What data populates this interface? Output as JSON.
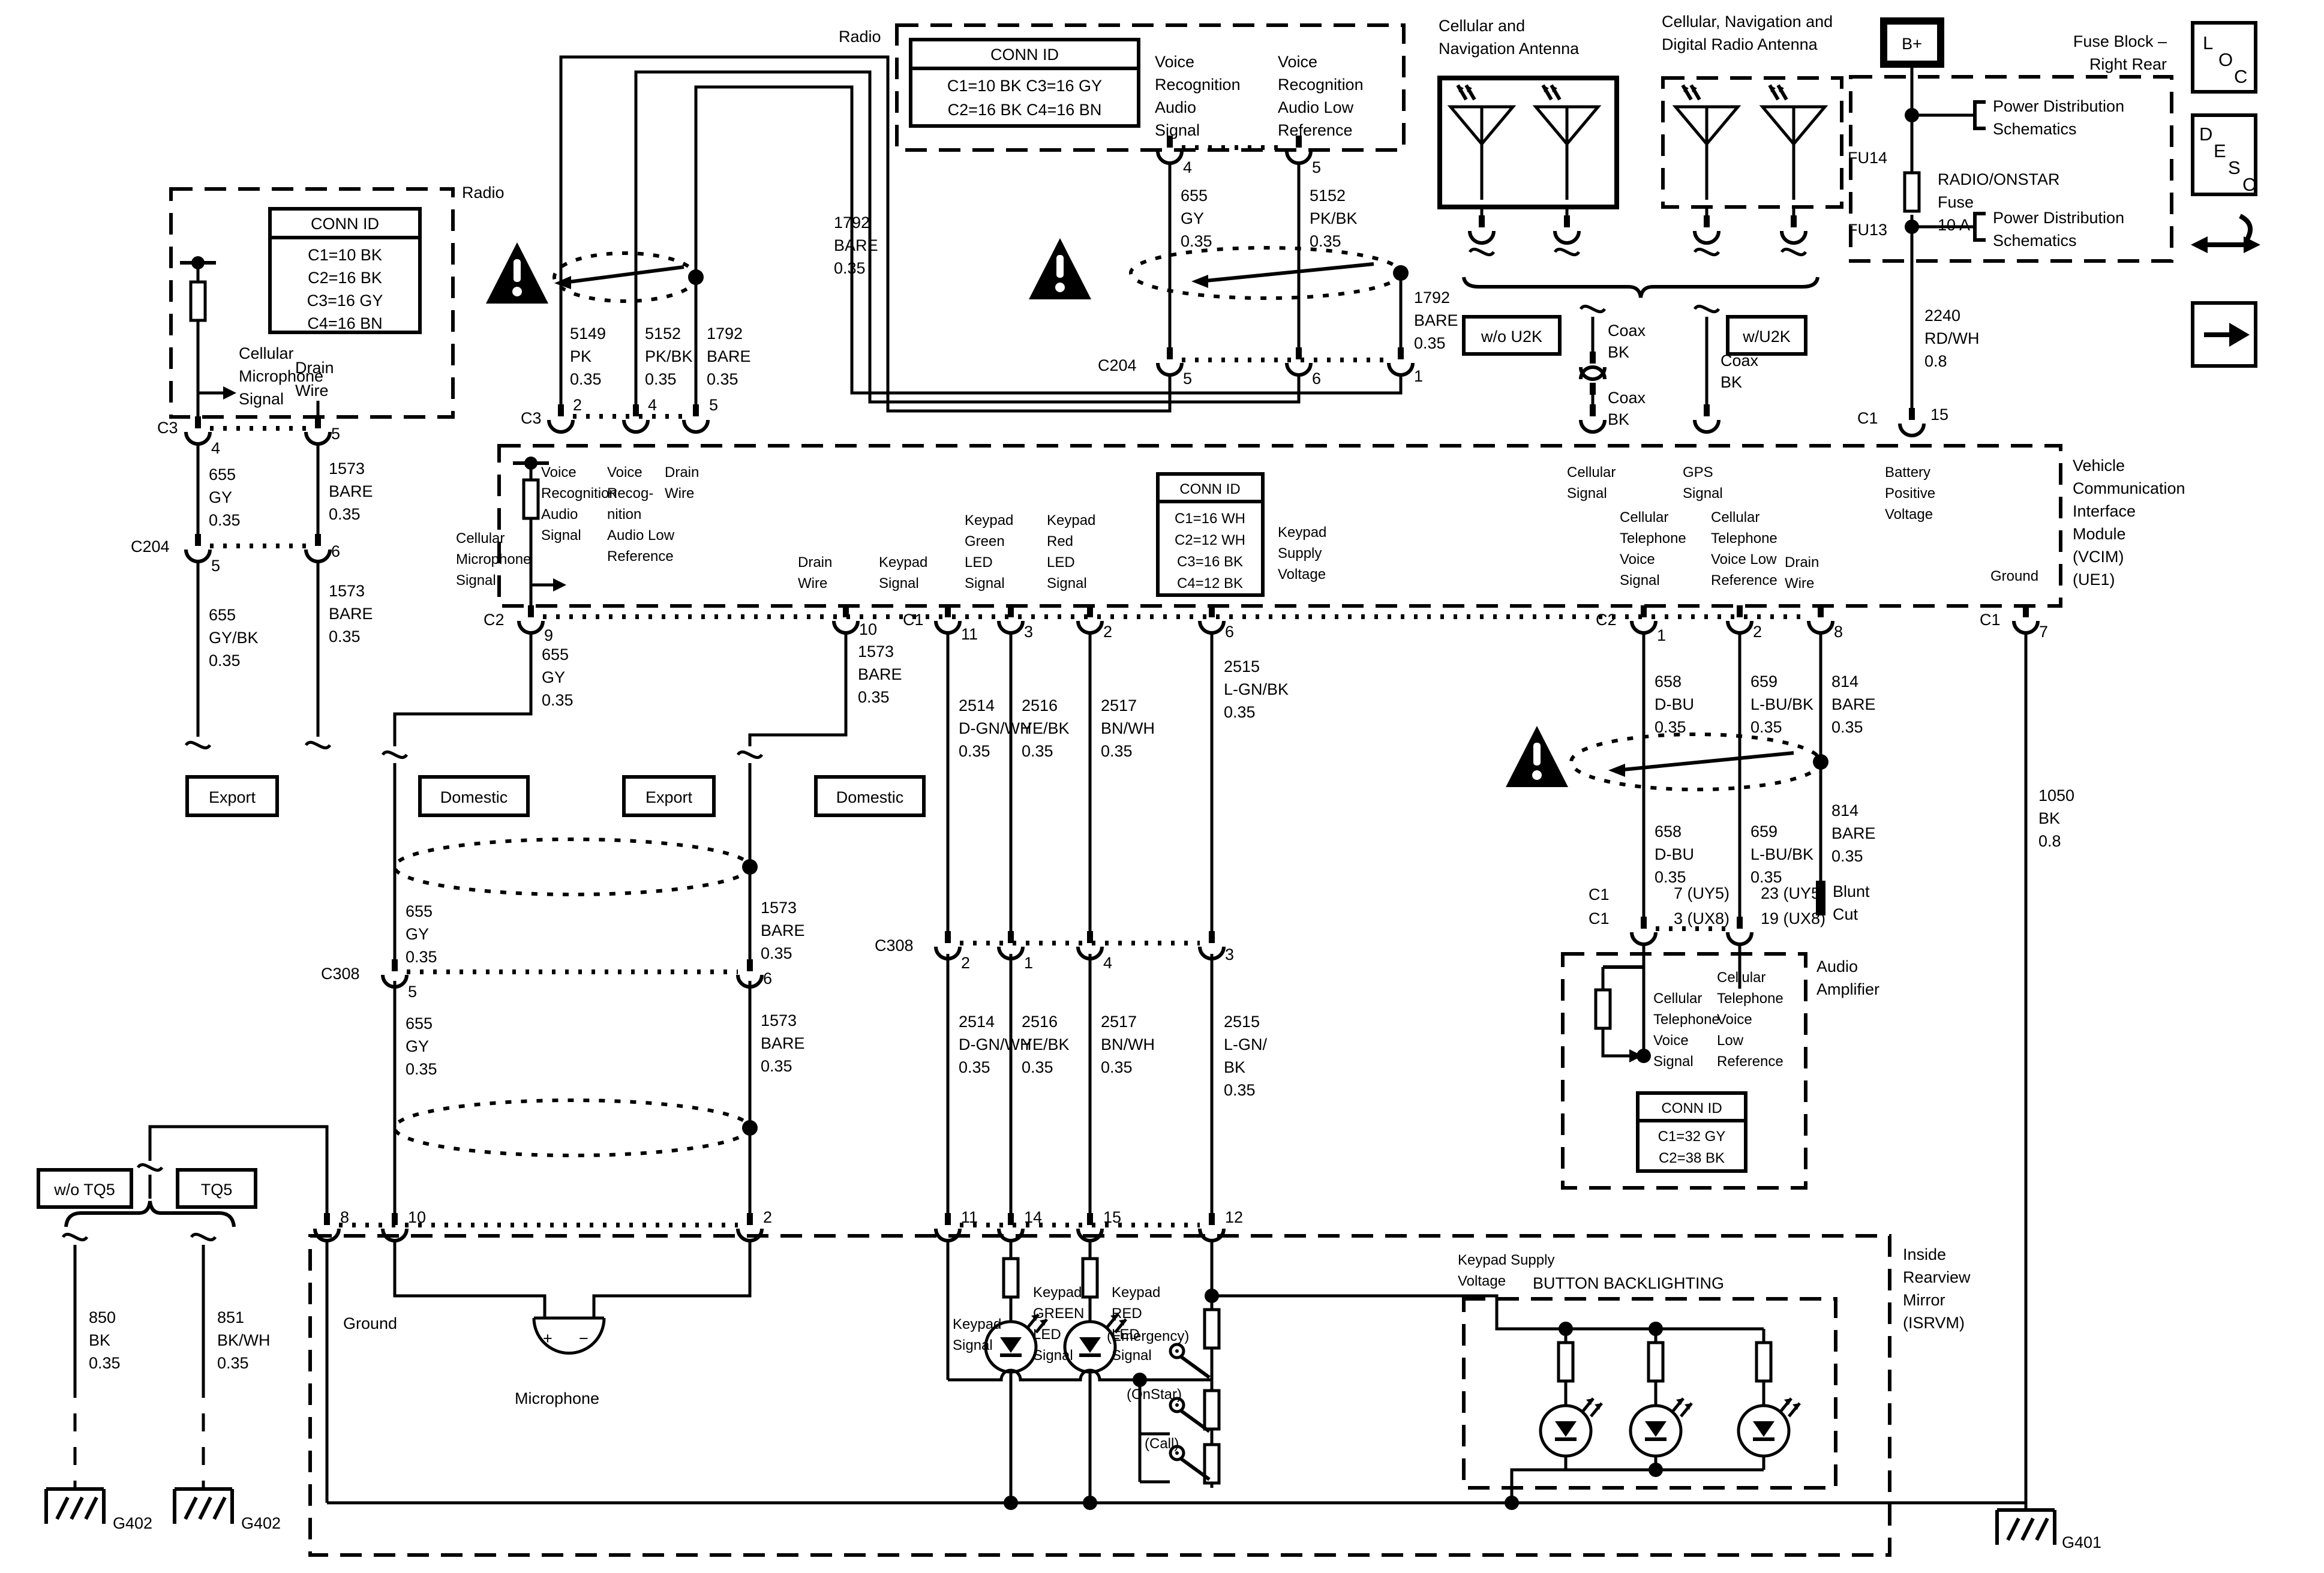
{
  "radio_left": {
    "title": "Radio",
    "conn": {
      "header": "CONN ID",
      "rows": [
        "C1=10 BK",
        "C2=16 BK",
        "C3=16 GY",
        "C4=16 BN"
      ]
    },
    "mic": "Cellular\nMicrophone\nSignal",
    "drain": "Drain\nWire"
  },
  "c3l": {
    "name": "C3",
    "p4": "4",
    "p5": "5",
    "w655": "655\nGY\n0.35",
    "w1573": "1573\nBARE\n0.35"
  },
  "c204l": {
    "name": "C204",
    "p5": "5",
    "p6": "6",
    "w655": "655\nGY/BK\n0.35",
    "w1573": "1573\nBARE\n0.35"
  },
  "nest": {
    "w5149": "5149\nPK\n0.35",
    "w5152": "5152\nPK/BK\n0.35",
    "w1792": "1792\nBARE\n0.35",
    "w1792b": "1792\nBARE\n0.35"
  },
  "radio_top": {
    "title": "Radio",
    "conn": {
      "header": "CONN ID",
      "row1": "C1=10 BK  C3=16 GY",
      "row2": "C2=16 BK  C4=16 BN"
    },
    "vr1": "Voice\nRecognition\nAudio\nSignal",
    "vr2": "Voice\nRecognition\nAudio Low\nReference",
    "p4": "4",
    "p5": "5",
    "w655": "655\nGY\n0.35",
    "w5152": "5152\nPK/BK\n0.35"
  },
  "c204m": {
    "name": "C204",
    "p5": "5",
    "p6": "6",
    "p1": "1",
    "w1792": "1792\nBARE\n0.35"
  },
  "ant": {
    "t1": "Cellular and\nNavigation Antenna",
    "t2": "Cellular, Navigation and\nDigital Radio Antenna",
    "wo": "w/o U2K",
    "w": "w/U2K",
    "coax1": "Coax\nBK",
    "coax2": "Coax\nBK",
    "coax3": "Coax\nBK"
  },
  "fuse": {
    "bplus": "B+",
    "title": "Fuse Block –\nRight Rear",
    "fu14": "FU14",
    "fu13": "FU13",
    "name": "RADIO/ONSTAR\nFuse\n10 A",
    "pds1": "Power Distribution\nSchematics",
    "pds2": "Power Distribution\nSchematics",
    "w2240": "2240\nRD/WH\n0.8",
    "c1": "C1",
    "p15": "15"
  },
  "icons": {
    "l": "L",
    "o": "O",
    "c": "C",
    "d": "D",
    "e": "E",
    "s": "S",
    "c2": "C"
  },
  "vcim": {
    "c3": "C3",
    "p2": "2",
    "p4": "4",
    "p5": "5",
    "vr1": "Voice\nRecognition\nAudio\nSignal",
    "vr2": "Voice\nRecog-\nnition\nAudio Low\nReference",
    "dw1": "Drain\nWire",
    "mic": "Cellular\nMicrophone\nSignal",
    "dw2": "Drain\nWire",
    "ks": "Keypad\nSignal",
    "kg": "Keypad\nGreen\nLED\nSignal",
    "kr": "Keypad\nRed\nLED\nSignal",
    "conn": {
      "header": "CONN ID",
      "rows": [
        "C1=16 WH",
        "C2=12 WH",
        "C3=16 BK",
        "C4=12 BK"
      ]
    },
    "ksup": "Keypad\nSupply\nVoltage",
    "cell": "Cellular\nSignal",
    "gps": "GPS\nSignal",
    "batt": "Battery\nPositive\nVoltage",
    "ctv": "Cellular\nTelephone\nVoice\nSignal",
    "ctl": "Cellular\nTelephone\nVoice Low\nReference",
    "dw3": "Drain\nWire",
    "gnd": "Ground",
    "module": "Vehicle\nCommunication\nInterface\nModule\n(VCIM)\n(UE1)",
    "c2a": "C2",
    "p9": "9",
    "p10": "10",
    "c1a": "C1",
    "p11": "11",
    "p3": "3",
    "p2b": "2",
    "p6": "6",
    "c2b": "C2",
    "p1": "1",
    "p2c": "2",
    "p8": "8",
    "c1b": "C1",
    "p7": "7"
  },
  "variant": {
    "b1": "Export",
    "b2": "Domestic",
    "b3": "Export",
    "b4": "Domestic"
  },
  "hl": {
    "w655a": "655\nGY\n0.35",
    "w1573a": "1573\nBARE\n0.35",
    "c308": "C308",
    "p5": "5",
    "p6": "6",
    "w655b": "655\nGY\n0.35",
    "w1573b": "1573\nBARE\n0.35"
  },
  "kw": {
    "w2514a": "2514\nD-GN/WH\n0.35",
    "w2516a": "2516\nYE/BK\n0.35",
    "w2517a": "2517\nBN/WH\n0.35",
    "w2515a": "2515\nL-GN/BK\n0.35",
    "c308": "C308",
    "p2": "2",
    "p1": "1",
    "p4": "4",
    "p3": "3",
    "w2514b": "2514\nD-GN/WH\n0.35",
    "w2516b": "2516\nYE/BK\n0.35",
    "w2517b": "2517\nBN/WH\n0.35",
    "w2515b": "2515\nL-GN/\nBK\n0.35"
  },
  "rw": {
    "w658a": "658\nD-BU\n0.35",
    "w659a": "659\nL-BU/BK\n0.35",
    "w814a": "814\nBARE\n0.35",
    "w658b": "658\nD-BU\n0.35",
    "w659b": "659\nL-BU/BK\n0.35",
    "w814b": "814\nBARE\n0.35",
    "blunt": "Blunt\nCut",
    "c1a": "C1",
    "c1b": "C1",
    "p7": "7 (UY5)",
    "p3": "3 (UX8)",
    "p23": "23 (UY5)",
    "p19": "19 (UX8)",
    "w1050": "1050\nBK\n0.8"
  },
  "amp": {
    "label": "Audio\nAmplifier",
    "ctv": "Cellular\nTelephone\nVoice\nSignal",
    "ctl": "Cellular\nTelephone\nVoice\nLow\nReference",
    "conn": {
      "header": "CONN ID",
      "rows": [
        "C1=32 GY",
        "C2=38 BK"
      ]
    }
  },
  "tq5": {
    "wo": "w/o TQ5",
    "t": "TQ5",
    "w850": "850\nBK\n0.35",
    "w851": "851\nBK/WH\n0.35",
    "g1": "G402",
    "g2": "G402"
  },
  "isrvm": {
    "p8": "8",
    "p10": "10",
    "p2": "2",
    "p11": "11",
    "p14": "14",
    "p15": "15",
    "p12": "12",
    "gnd": "Ground",
    "micp": "+",
    "micm": "−",
    "mic": "Microphone",
    "ks": "Keypad\nSignal",
    "kg": "Keypad\nGREEN\nLED\nSignal",
    "kr": "Keypad\nRED\nLED\nSignal",
    "sw1": "(Emergency)",
    "sw2": "(OnStar)",
    "sw3": "(Call)",
    "ksup": "Keypad Supply\nVoltage",
    "bb": "BUTTON BACKLIGHTING",
    "label": "Inside\nRearview\nMirror\n(ISRVM)",
    "g401": "G401"
  }
}
